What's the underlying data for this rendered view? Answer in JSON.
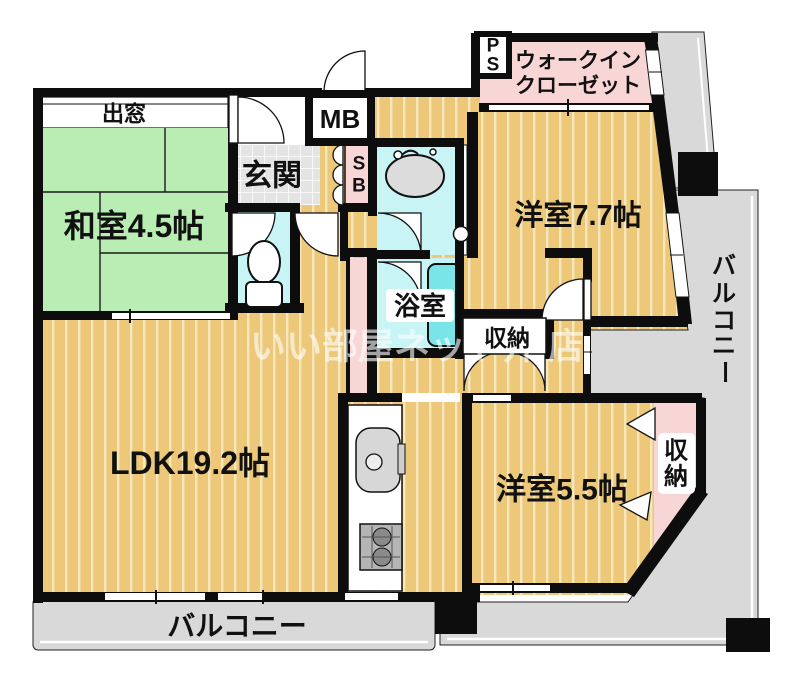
{
  "fp": {
    "title": "apartment-floorplan",
    "labels": {
      "demado": "出窓",
      "washitsu": "和室4.5帖",
      "genkan": "玄関",
      "mb": "MB",
      "sb": [
        "S",
        "B"
      ],
      "ps": [
        "P",
        "S"
      ],
      "wic_line1": "ウォークイン",
      "wic_line2": "クローゼット",
      "yoshitsu77": "洋室7.7帖",
      "yokushitsu": "浴室",
      "shuno_mid": "収納",
      "ldk": "LDK19.2帖",
      "yoshitsu55": "洋室5.5帖",
      "shuno_right": [
        "収",
        "納"
      ],
      "balcony_bottom": "バルコニー",
      "balcony_right_chars": [
        "バ",
        "ル",
        "コ",
        "ニ",
        "ー"
      ]
    },
    "watermark": {
      "part1": "いい部屋ネット井",
      "part2": "店"
    },
    "colors": {
      "flooring": "#ecc878",
      "tatami": "#b9edb4",
      "wet": "#c9f4f6",
      "tub": "#79e5e9",
      "pink": "#f8d6d6",
      "tile": "#e4e4e4",
      "balcony": "#d9d9d9",
      "wall": "#0d0d0d",
      "fixture_gray": "#d7d7d7"
    }
  }
}
